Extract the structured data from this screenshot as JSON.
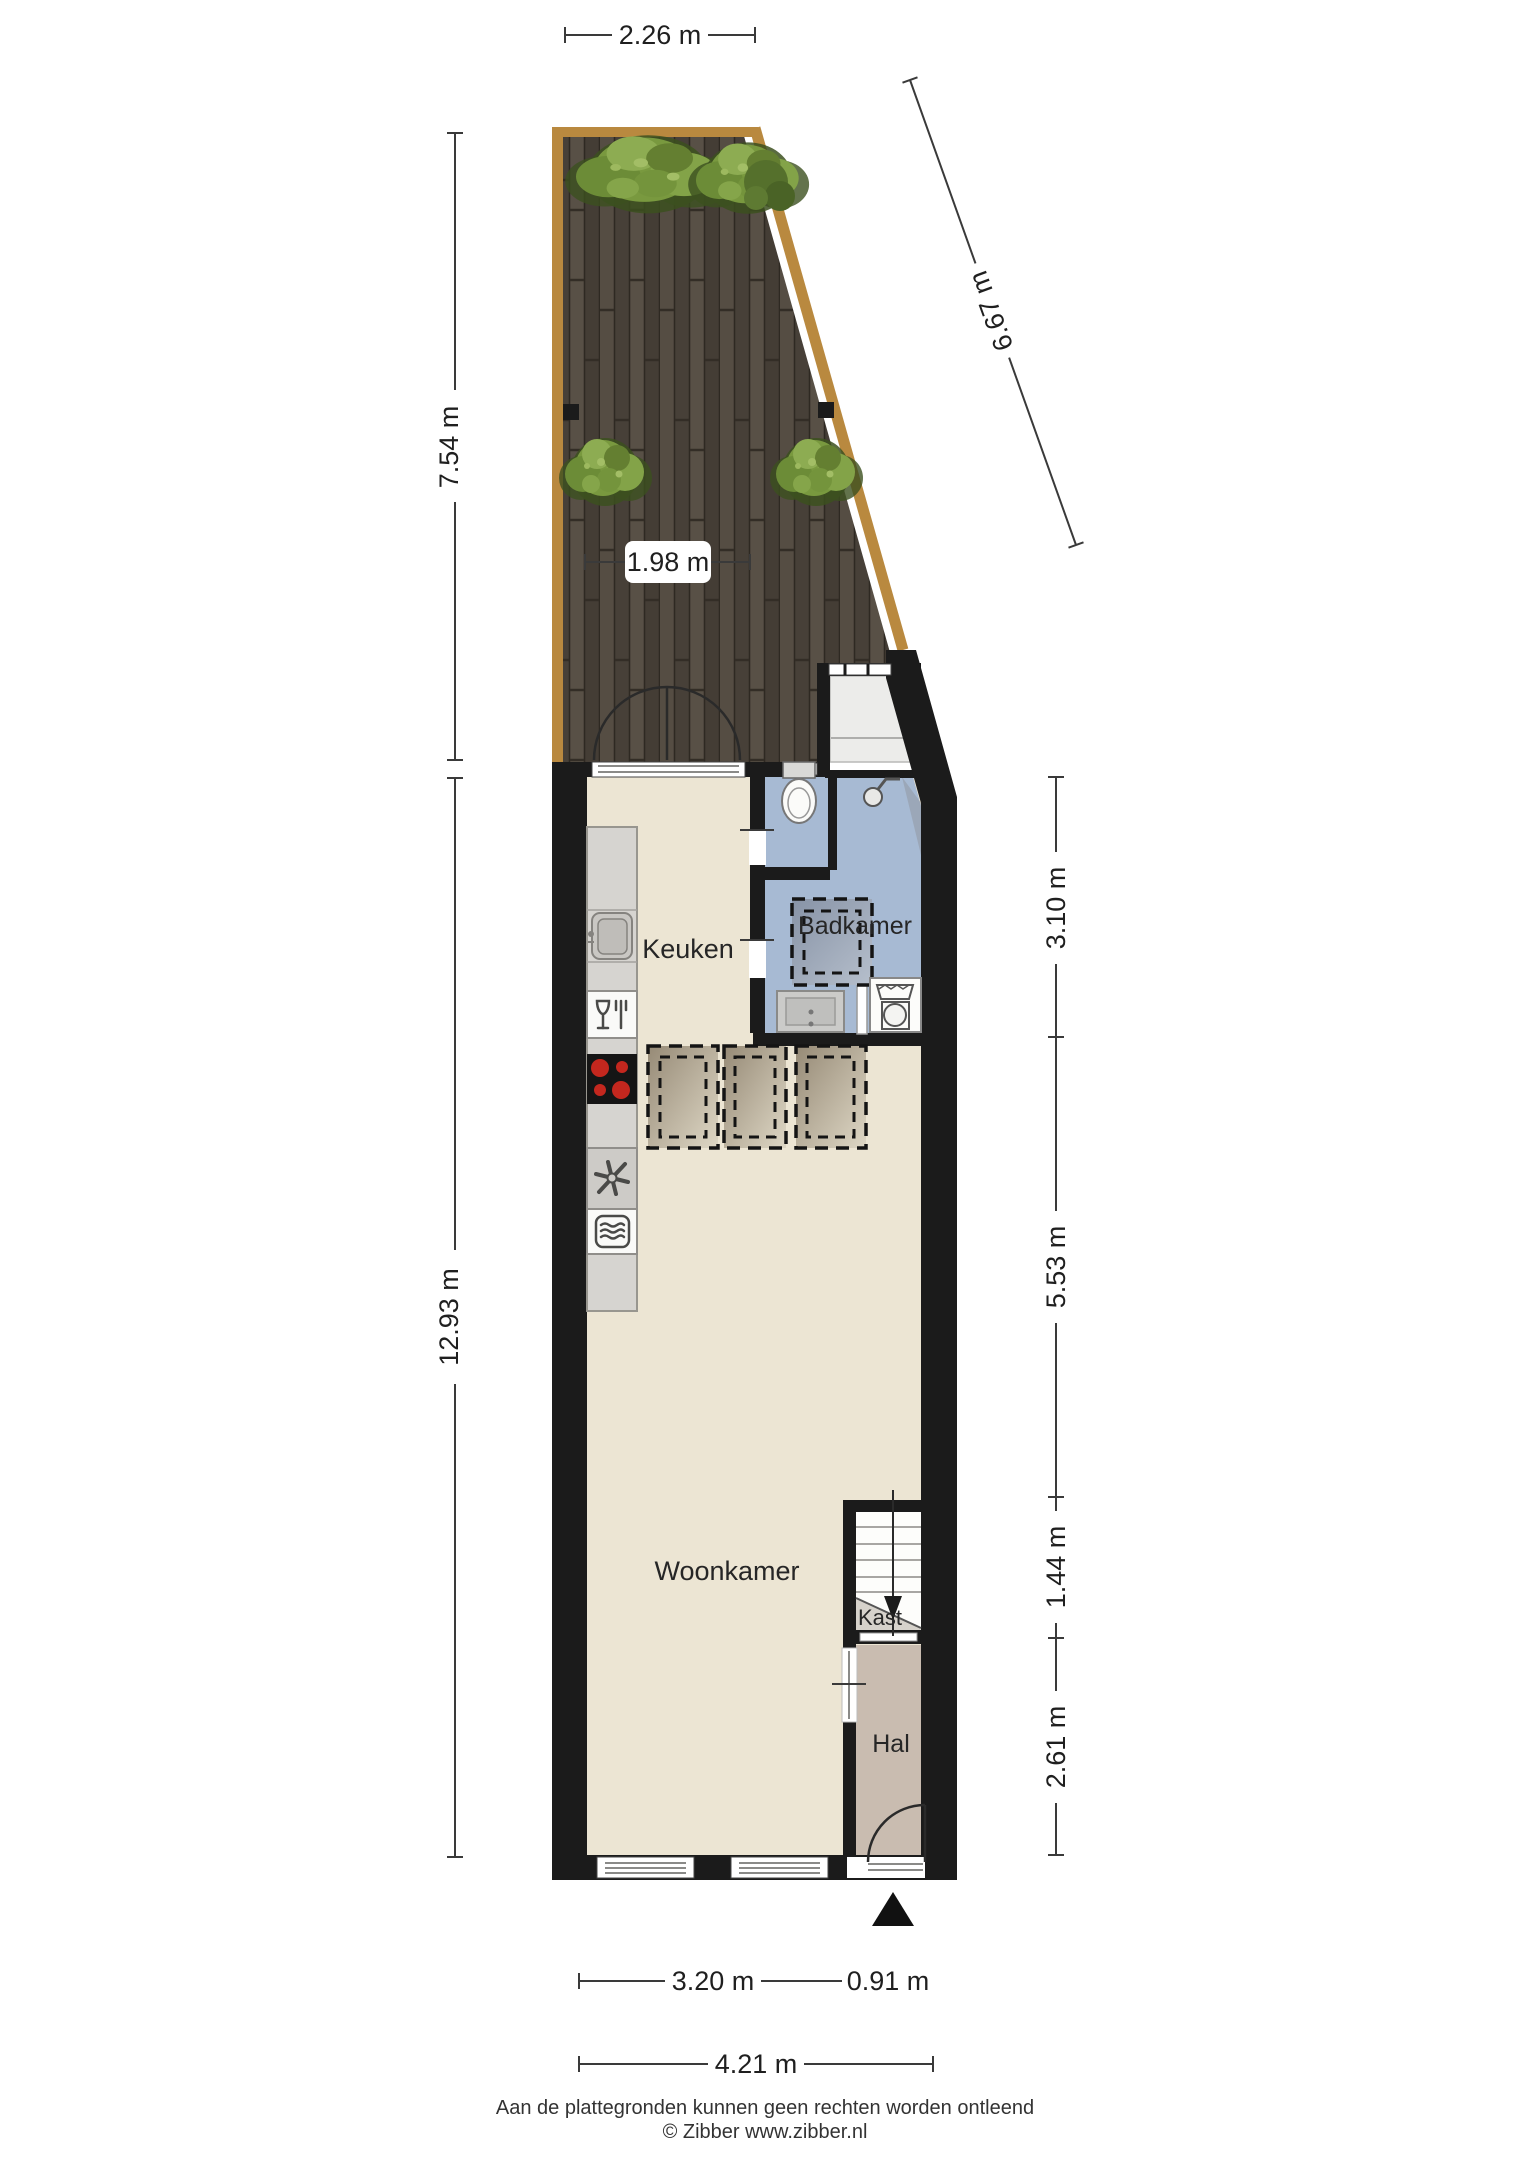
{
  "floorplan": {
    "rooms": {
      "kitchen": "Keuken",
      "bathroom": "Badkamer",
      "living": "Woonkamer",
      "closet": "Kast",
      "hall": "Hal"
    },
    "dimensions": {
      "garden_width_top": "2.26 m",
      "garden_depth_left": "7.54 m",
      "plot_edge_right": "6.67 m",
      "garden_width_inner": "1.98 m",
      "house_depth_left": "12.93 m",
      "right_top": "3.10 m",
      "right_mid": "5.53 m",
      "right_lower": "1.44 m",
      "right_bottom": "2.61 m",
      "bottom_living": "3.20 m",
      "bottom_hall": "0.91 m",
      "bottom_total": "4.21 m"
    },
    "footer": {
      "disclaimer": "Aan de plattegronden kunnen geen rechten worden ontleend",
      "copyright": "© Zibber www.zibber.nl"
    },
    "colors": {
      "wall": "#1b1b1b",
      "floor": "#ece5d3",
      "bathroom_floor": "#a7bad3",
      "hall_floor": "#c9bcb0",
      "closet_floor": "#d6d2cb",
      "deck_border": "#b9893f",
      "bush_green": "#79993f",
      "hob_burner": "#c4271e",
      "dim_line": "#3a3a3a"
    }
  }
}
